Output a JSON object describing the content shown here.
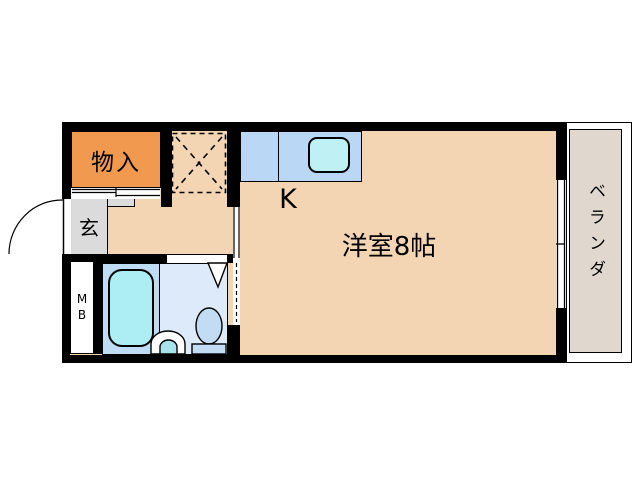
{
  "floor_plan": {
    "rooms": {
      "storage": {
        "label": "物入",
        "color": "#F0994F"
      },
      "entrance": {
        "label": "玄",
        "color": "#DBDBDB"
      },
      "kitchen": {
        "label": "K",
        "floor_color": "#F3D5B3"
      },
      "main_room": {
        "label": "洋室8帖",
        "floor_color": "#F3D5B3"
      },
      "veranda": {
        "label": "ベランダ",
        "color": "#E0D8CF"
      },
      "meter_box": {
        "label": "MB"
      }
    },
    "fixtures": {
      "kitchen_counter": "kitchen-counter-with-sink",
      "refrigerator_space": "dashed-refrigerator-space",
      "bathtub": "bathtub",
      "toilet": "toilet",
      "washbasin": "washbasin",
      "entry_door": "entry-door-swing-arc",
      "closet_sliding_door": "sliding-door",
      "room_sliding_door": "sliding-door",
      "bath_folding_door": "folding-door",
      "balcony_window": "sliding-window"
    },
    "colors": {
      "wall": "#000000",
      "floor": "#F3D5B3",
      "storage_orange": "#F0994F",
      "counter_blue": "#BAD7F5",
      "sink_cyan": "#BFF0F4",
      "bath_left_blue": "#BFDCF5",
      "bathtub_cyan": "#ADEDF4",
      "bath_right_blue": "#DDEAFA",
      "toilet_blue": "#C2DCF4",
      "entrance_gray": "#DBDBDB",
      "veranda_gray": "#E0D8CF",
      "background": "#FFFFFF"
    }
  }
}
